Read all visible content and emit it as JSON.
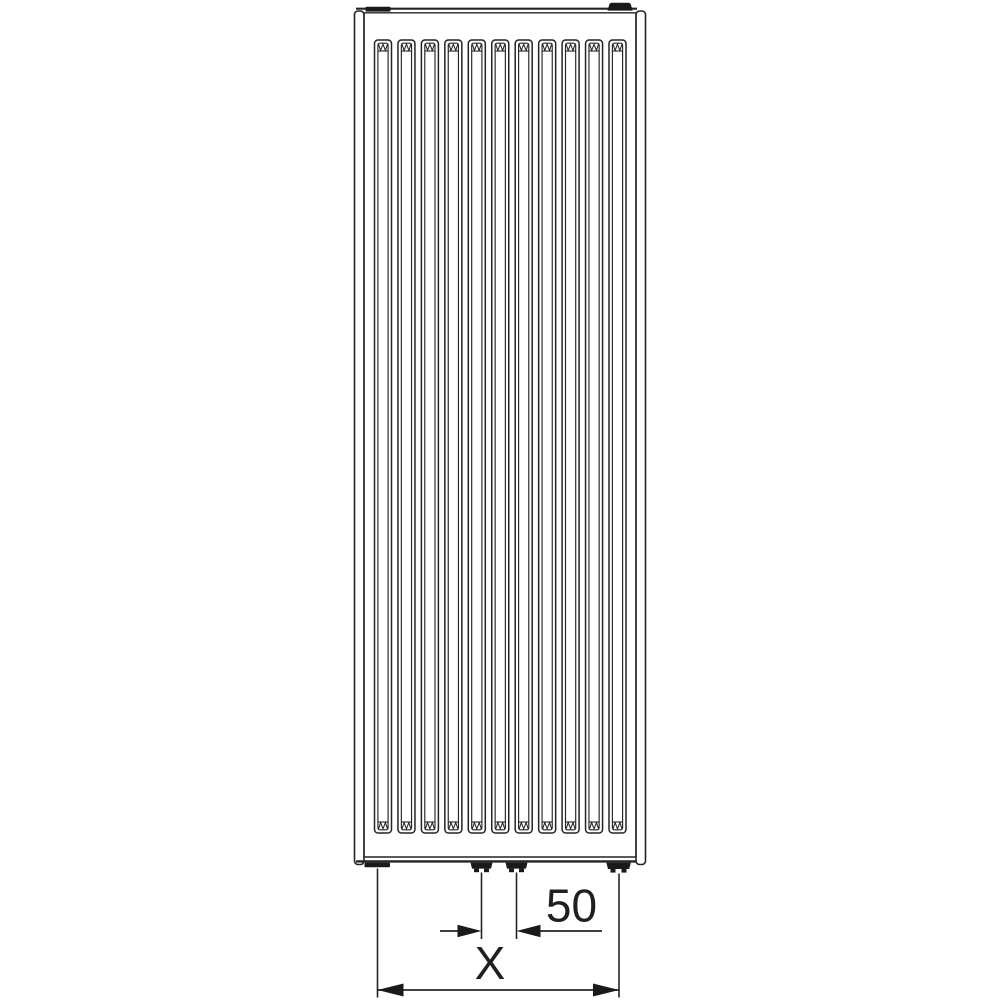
{
  "diagram": {
    "type": "radiator-front-view-technical-drawing",
    "description": "Vertical panel radiator line drawing with bottom connection dimensioning",
    "dimensions": {
      "connection_spacing_label": "50",
      "overall_width_label": "X"
    },
    "slots": {
      "count": 11
    },
    "connections": {
      "bottom_center_stubs": 2,
      "bottom_corner_stubs": 2,
      "top_plugs": 2
    },
    "colors": {
      "line": "#242424",
      "dark_fill": "#1a1a1a",
      "background": "#ffffff"
    }
  }
}
